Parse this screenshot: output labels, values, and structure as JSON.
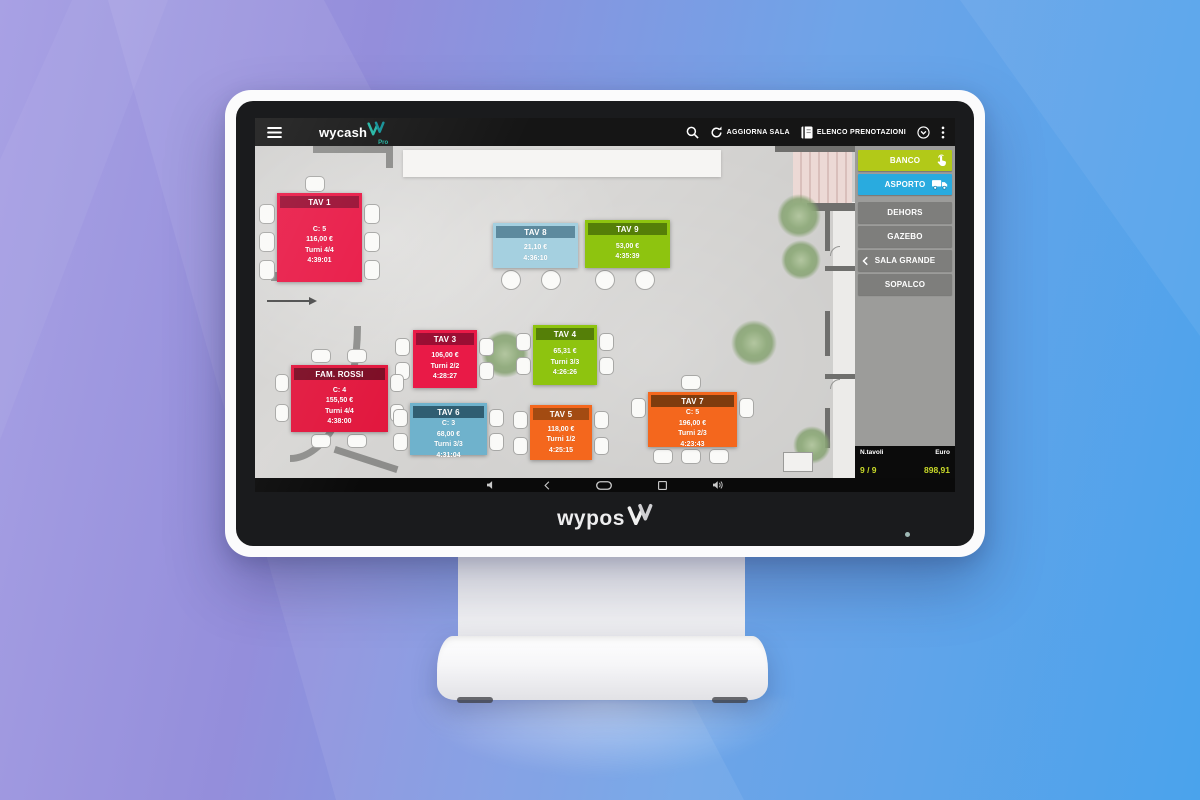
{
  "device": {
    "brand": "wypos",
    "led_color": "#9fb9b5"
  },
  "appbar": {
    "brand": "wycash",
    "brand_sub": "Pro",
    "actions": [
      {
        "icon": "refresh-icon",
        "label": "AGGIORNA SALA"
      },
      {
        "icon": "reservations-book-icon",
        "label": "ELENCO PRENOTAZIONI"
      }
    ]
  },
  "navbar": {
    "icons": [
      "volume-down-icon",
      "back-icon",
      "home-icon",
      "recents-icon",
      "volume-up-icon"
    ]
  },
  "sidebar": {
    "rooms": [
      {
        "label": "BANCO",
        "bg": "#b2c918",
        "icon": "tap-icon",
        "icon_side": "right",
        "active": true
      },
      {
        "label": "ASPORTO",
        "bg": "#29abdf",
        "icon": "truck-icon",
        "icon_side": "right",
        "active": true
      },
      {
        "label": "DEHORS",
        "bg": "#7e7e7c",
        "gap_before": true
      },
      {
        "label": "GAZEBO",
        "bg": "#7e7e7c"
      },
      {
        "label": "SALA GRANDE",
        "bg": "#7e7e7c",
        "icon": "back-chevron-icon",
        "icon_side": "left"
      },
      {
        "label": "SOPALCO",
        "bg": "#7e7e7c"
      }
    ],
    "footer": {
      "tables_label": "N.tavoli",
      "tables_value": "9 / 9",
      "euro_label": "Euro",
      "euro_value": "898,91",
      "value_color": "#c9da29"
    }
  },
  "floorplan": {
    "tables": [
      {
        "name": "TAV 1",
        "x": 22,
        "y": 47,
        "w": 85,
        "h": 89,
        "bg": "#e91a47",
        "header_bg": "#9a0e33",
        "lines": [
          "C: 5",
          "116,00 €",
          "Turni 4/4",
          "4:39:01"
        ]
      },
      {
        "name": "TAV 8",
        "x": 238,
        "y": 77,
        "w": 85,
        "h": 45,
        "bg": "#a5d0e0",
        "header_bg": "#5d8a9e",
        "lines": [
          "21,10 €",
          "4:36:10"
        ]
      },
      {
        "name": "TAV 9",
        "x": 330,
        "y": 74,
        "w": 85,
        "h": 48,
        "bg": "#8ec40f",
        "header_bg": "#557f08",
        "lines": [
          "53,00 €",
          "4:35:39"
        ]
      },
      {
        "name": "TAV 3",
        "x": 158,
        "y": 184,
        "w": 64,
        "h": 58,
        "bg": "#e91a47",
        "header_bg": "#9a0e33",
        "lines": [
          "106,00 €",
          "Turni 2/2",
          "4:28:27"
        ]
      },
      {
        "name": "TAV 4",
        "x": 278,
        "y": 179,
        "w": 64,
        "h": 60,
        "bg": "#8ec40f",
        "header_bg": "#557f08",
        "lines": [
          "65,31 €",
          "Turni 3/3",
          "4:26:26"
        ]
      },
      {
        "name": "FAM. ROSSI",
        "x": 36,
        "y": 219,
        "w": 97,
        "h": 67,
        "bg": "#e2173e",
        "header_bg": "#7c0c24",
        "lines": [
          "C: 4",
          "155,50 €",
          "Turni 4/4",
          "4:38:00"
        ]
      },
      {
        "name": "TAV 6",
        "x": 155,
        "y": 257,
        "w": 77,
        "h": 52,
        "bg": "#6fb2cc",
        "header_bg": "#305e72",
        "lines": [
          "C: 3",
          "68,00 €",
          "Turni 3/3",
          "4:31:04"
        ]
      },
      {
        "name": "TAV 5",
        "x": 275,
        "y": 259,
        "w": 62,
        "h": 55,
        "bg": "#f4671d",
        "header_bg": "#a34b12",
        "lines": [
          "118,00 €",
          "Turni 1/2",
          "4:25:15"
        ]
      },
      {
        "name": "TAV 7",
        "x": 393,
        "y": 246,
        "w": 89,
        "h": 55,
        "bg": "#f4671d",
        "header_bg": "#7e3c0e",
        "lines": [
          "C: 5",
          "196,00 €",
          "Turni 2/3",
          "4:23:43"
        ]
      }
    ],
    "decor": [
      {
        "type": "white-area",
        "x": 578,
        "y": 56,
        "w": 22,
        "h": 276
      },
      {
        "type": "wall",
        "x": 58,
        "y": 0,
        "w": 80,
        "h": 7
      },
      {
        "type": "wall",
        "x": 131,
        "y": 0,
        "w": 7,
        "h": 22
      },
      {
        "type": "counter",
        "x": 148,
        "y": 4,
        "w": 318,
        "h": 27
      },
      {
        "type": "wall-dark",
        "x": 520,
        "y": 0,
        "w": 80,
        "h": 6
      },
      {
        "type": "tiles",
        "x": 538,
        "y": 6,
        "w": 59,
        "h": 51
      },
      {
        "type": "wall-dark",
        "x": 552,
        "y": 57,
        "w": 48,
        "h": 8
      },
      {
        "type": "wall-dark",
        "x": 570,
        "y": 65,
        "w": 5,
        "h": 40
      },
      {
        "type": "wall-dark",
        "x": 570,
        "y": 120,
        "w": 30,
        "h": 5
      },
      {
        "type": "wall-dark",
        "x": 570,
        "y": 165,
        "w": 5,
        "h": 45
      },
      {
        "type": "wall-dark",
        "x": 570,
        "y": 228,
        "w": 30,
        "h": 5
      },
      {
        "type": "wall-dark",
        "x": 570,
        "y": 262,
        "w": 5,
        "h": 40
      },
      {
        "type": "door",
        "x": 575,
        "y": 100,
        "w": 20,
        "h": 20
      },
      {
        "type": "door",
        "x": 575,
        "y": 233,
        "w": 20,
        "h": 20
      },
      {
        "type": "wall",
        "x": 16,
        "y": 126,
        "w": 72,
        "h": 9
      },
      {
        "type": "arrow",
        "x": 12,
        "y": 154,
        "w": 48,
        "h": 2
      },
      {
        "type": "arc",
        "x": -36,
        "y": 44,
        "w": 142,
        "h": 272
      },
      {
        "type": "wall",
        "x": 78,
        "y": 310,
        "w": 66,
        "h": 7,
        "rot": 18
      },
      {
        "type": "tree",
        "x": 522,
        "y": 48,
        "w": 44,
        "h": 44
      },
      {
        "type": "tree",
        "x": 526,
        "y": 94,
        "w": 40,
        "h": 40
      },
      {
        "type": "tree",
        "x": 476,
        "y": 174,
        "w": 46,
        "h": 46
      },
      {
        "type": "tree",
        "x": 226,
        "y": 184,
        "w": 48,
        "h": 48
      },
      {
        "type": "tree",
        "x": 538,
        "y": 280,
        "w": 38,
        "h": 38
      },
      {
        "type": "box",
        "x": 528,
        "y": 306,
        "w": 30,
        "h": 20
      },
      {
        "type": "chair",
        "x": 4,
        "y": 58,
        "w": 16,
        "h": 20
      },
      {
        "type": "chair",
        "x": 4,
        "y": 86,
        "w": 16,
        "h": 20
      },
      {
        "type": "chair",
        "x": 4,
        "y": 114,
        "w": 16,
        "h": 20
      },
      {
        "type": "chair",
        "x": 109,
        "y": 58,
        "w": 16,
        "h": 20
      },
      {
        "type": "chair",
        "x": 109,
        "y": 86,
        "w": 16,
        "h": 20
      },
      {
        "type": "chair",
        "x": 109,
        "y": 114,
        "w": 16,
        "h": 20
      },
      {
        "type": "chair",
        "x": 50,
        "y": 30,
        "w": 20,
        "h": 16
      },
      {
        "type": "chair-round",
        "x": 246,
        "y": 124,
        "w": 20,
        "h": 20
      },
      {
        "type": "chair-round",
        "x": 286,
        "y": 124,
        "w": 20,
        "h": 20
      },
      {
        "type": "chair-round",
        "x": 340,
        "y": 124,
        "w": 20,
        "h": 20
      },
      {
        "type": "chair-round",
        "x": 380,
        "y": 124,
        "w": 20,
        "h": 20
      },
      {
        "type": "chair",
        "x": 140,
        "y": 192,
        "w": 15,
        "h": 18
      },
      {
        "type": "chair",
        "x": 140,
        "y": 216,
        "w": 15,
        "h": 18
      },
      {
        "type": "chair",
        "x": 224,
        "y": 192,
        "w": 15,
        "h": 18
      },
      {
        "type": "chair",
        "x": 224,
        "y": 216,
        "w": 15,
        "h": 18
      },
      {
        "type": "chair",
        "x": 261,
        "y": 187,
        "w": 15,
        "h": 18
      },
      {
        "type": "chair",
        "x": 261,
        "y": 211,
        "w": 15,
        "h": 18
      },
      {
        "type": "chair",
        "x": 344,
        "y": 187,
        "w": 15,
        "h": 18
      },
      {
        "type": "chair",
        "x": 344,
        "y": 211,
        "w": 15,
        "h": 18
      },
      {
        "type": "chair",
        "x": 20,
        "y": 228,
        "w": 14,
        "h": 18
      },
      {
        "type": "chair",
        "x": 20,
        "y": 258,
        "w": 14,
        "h": 18
      },
      {
        "type": "chair",
        "x": 135,
        "y": 228,
        "w": 14,
        "h": 18
      },
      {
        "type": "chair",
        "x": 135,
        "y": 258,
        "w": 14,
        "h": 18
      },
      {
        "type": "chair",
        "x": 56,
        "y": 203,
        "w": 20,
        "h": 14
      },
      {
        "type": "chair",
        "x": 92,
        "y": 203,
        "w": 20,
        "h": 14
      },
      {
        "type": "chair",
        "x": 56,
        "y": 288,
        "w": 20,
        "h": 14
      },
      {
        "type": "chair",
        "x": 92,
        "y": 288,
        "w": 20,
        "h": 14
      },
      {
        "type": "chair",
        "x": 138,
        "y": 263,
        "w": 15,
        "h": 18
      },
      {
        "type": "chair",
        "x": 138,
        "y": 287,
        "w": 15,
        "h": 18
      },
      {
        "type": "chair",
        "x": 234,
        "y": 263,
        "w": 15,
        "h": 18
      },
      {
        "type": "chair",
        "x": 234,
        "y": 287,
        "w": 15,
        "h": 18
      },
      {
        "type": "chair",
        "x": 258,
        "y": 265,
        "w": 15,
        "h": 18
      },
      {
        "type": "chair",
        "x": 258,
        "y": 291,
        "w": 15,
        "h": 18
      },
      {
        "type": "chair",
        "x": 339,
        "y": 265,
        "w": 15,
        "h": 18
      },
      {
        "type": "chair",
        "x": 339,
        "y": 291,
        "w": 15,
        "h": 18
      },
      {
        "type": "chair",
        "x": 376,
        "y": 252,
        "w": 15,
        "h": 20
      },
      {
        "type": "chair",
        "x": 484,
        "y": 252,
        "w": 15,
        "h": 20
      },
      {
        "type": "chair",
        "x": 398,
        "y": 303,
        "w": 20,
        "h": 15
      },
      {
        "type": "chair",
        "x": 426,
        "y": 303,
        "w": 20,
        "h": 15
      },
      {
        "type": "chair",
        "x": 454,
        "y": 303,
        "w": 20,
        "h": 15
      },
      {
        "type": "chair",
        "x": 426,
        "y": 229,
        "w": 20,
        "h": 15
      }
    ]
  }
}
